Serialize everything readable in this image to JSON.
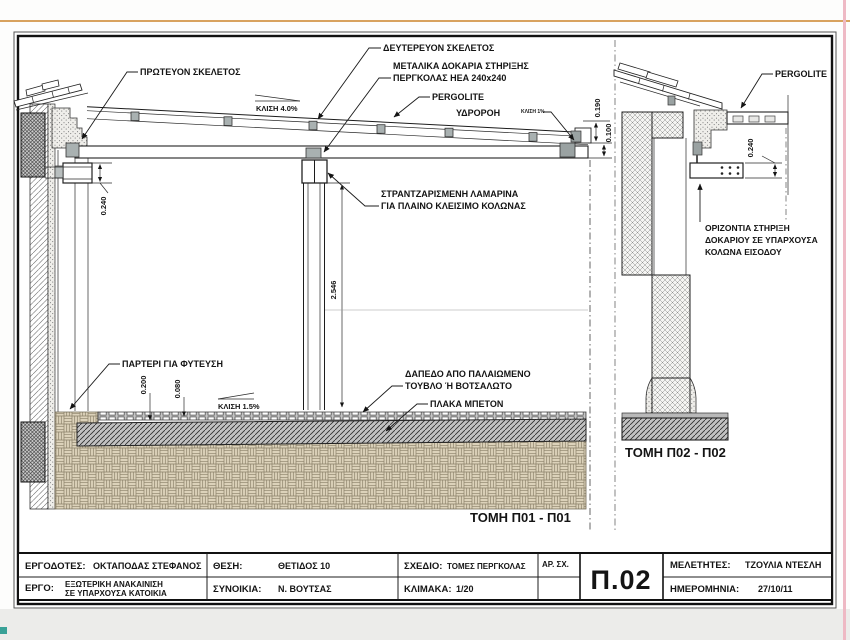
{
  "artifacts": {
    "top_line_color": "#d8a25e",
    "right_line_color": "#eeb9c4",
    "corner_mark_color": "#39a197"
  },
  "drawing": {
    "section1": {
      "caption": "ΤΟΜΗ Π01 - Π01",
      "labels": {
        "primary_frame": "ΠΡΩΤΕΥΟΝ ΣΚΕΛΕΤΟΣ",
        "secondary_frame": "ΔΕΥΤΕΡΕΥΟΝ ΣΚΕΛΕΤΟΣ",
        "metal_beams_line1": "ΜΕΤΑΛΙΚΑ  ΔΟΚΑΡΙΑ ΣΤΗΡΙΞΗΣ",
        "metal_beams_line2": "ΠΕΡΓΚΟΛΑΣ HEA 240x240",
        "pergolite": "PERGOLITE",
        "roof_slope": "ΚΛΙΣΗ 4.0%",
        "gutter": "ΥΔΡΟΡΟΗ",
        "gutter_slope": "ΚΛΙΣΗ 1%",
        "sheet_metal_line1": "ΣΤΡΑΝΤΖΑΡΙΣΜΕΝΗ ΛΑΜΑΡΙΝΑ",
        "sheet_metal_line2": "ΓΙΑ ΠΛΑΙΝΟ ΚΛΕΙΣΙΜΟ ΚΟΛΩΝΑΣ",
        "planter": "ΠΑΡΤΕΡΙ ΓΙΑ ΦΥΤΕΥΣΗ",
        "floor_slope": "ΚΛΙΣΗ 1.5%",
        "floor_line1": "ΔΑΠΕΔΟ ΑΠΟ ΠΑΛΑΙΩΜΕΝΟ",
        "floor_line2": "ΤΟΥΒΛΟ Ή ΒΟΤΣΑΛΩΤΟ",
        "concrete_slab": "ΠΛΑΚΑ ΜΠΕΤΟΝ"
      },
      "dimensions": {
        "beam_height": "0.240",
        "clear_height": "2.546",
        "floor_build": "0.200",
        "tile_bed": "0.080",
        "gutter_height": "0.190",
        "beam_edge": "0.100"
      }
    },
    "section2": {
      "caption": "ΤΟΜΗ Π02 - Π02",
      "labels": {
        "pergolite": "PERGOLITE",
        "support_line1": "ΟΡΙΖΟΝΤΙΑ ΣΤΗΡΙΞΗ",
        "support_line2": "ΔΟΚΑΡΙΟΥ ΣΕ ΥΠΑΡΧΟΥΣΑ",
        "support_line3": "ΚΟΛΩΝΑ ΕΙΣΟΔΟΥ"
      },
      "dimensions": {
        "beam_height": "0.240"
      }
    }
  },
  "title_block": {
    "ergodotes_label": "ΕΡΓΟΔΟΤΕΣ:",
    "ergodotes_value": "ΟΚΤΑΠΟΔΑΣ ΣΤΕΦΑΝΟΣ",
    "ergo_label": "ΕΡΓΟ:",
    "ergo_value_line1": "ΕΞΩΤΕΡΙΚΗ ΑΝΑΚΑΙΝΙΣΗ",
    "ergo_value_line2": "ΣΕ ΥΠΑΡΧΟΥΣΑ ΚΑΤΟΙΚΙΑ",
    "thesi_label": "ΘΕΣΗ:",
    "thesi_value": "ΘΕΤΙΔΟΣ 10",
    "synoikia_label": "ΣΥΝΟΙΚΙΑ:",
    "synoikia_value": "Ν. ΒΟΥΤΣΑΣ",
    "sxedio_label": "ΣΧΕΔΙΟ:",
    "sxedio_value": "ΤΟΜΕΣ ΠΕΡΓΚΟΛΑΣ",
    "klimaka_label": "ΚΛΙΜΑΚΑ:",
    "klimaka_value": "1/20",
    "ar_sx_label": "ΑΡ. ΣΧ.",
    "drawing_number": "Π.02",
    "meletites_label": "ΜΕΛΕΤΗΤΕΣ:",
    "meletites_value": "ΤΖΟΥΛΙΑ ΝΤΕΣΛΗ",
    "imerominia_label": "ΗΜΕΡΟΜΗΝΙΑ:",
    "imerominia_value": "27/10/11"
  }
}
